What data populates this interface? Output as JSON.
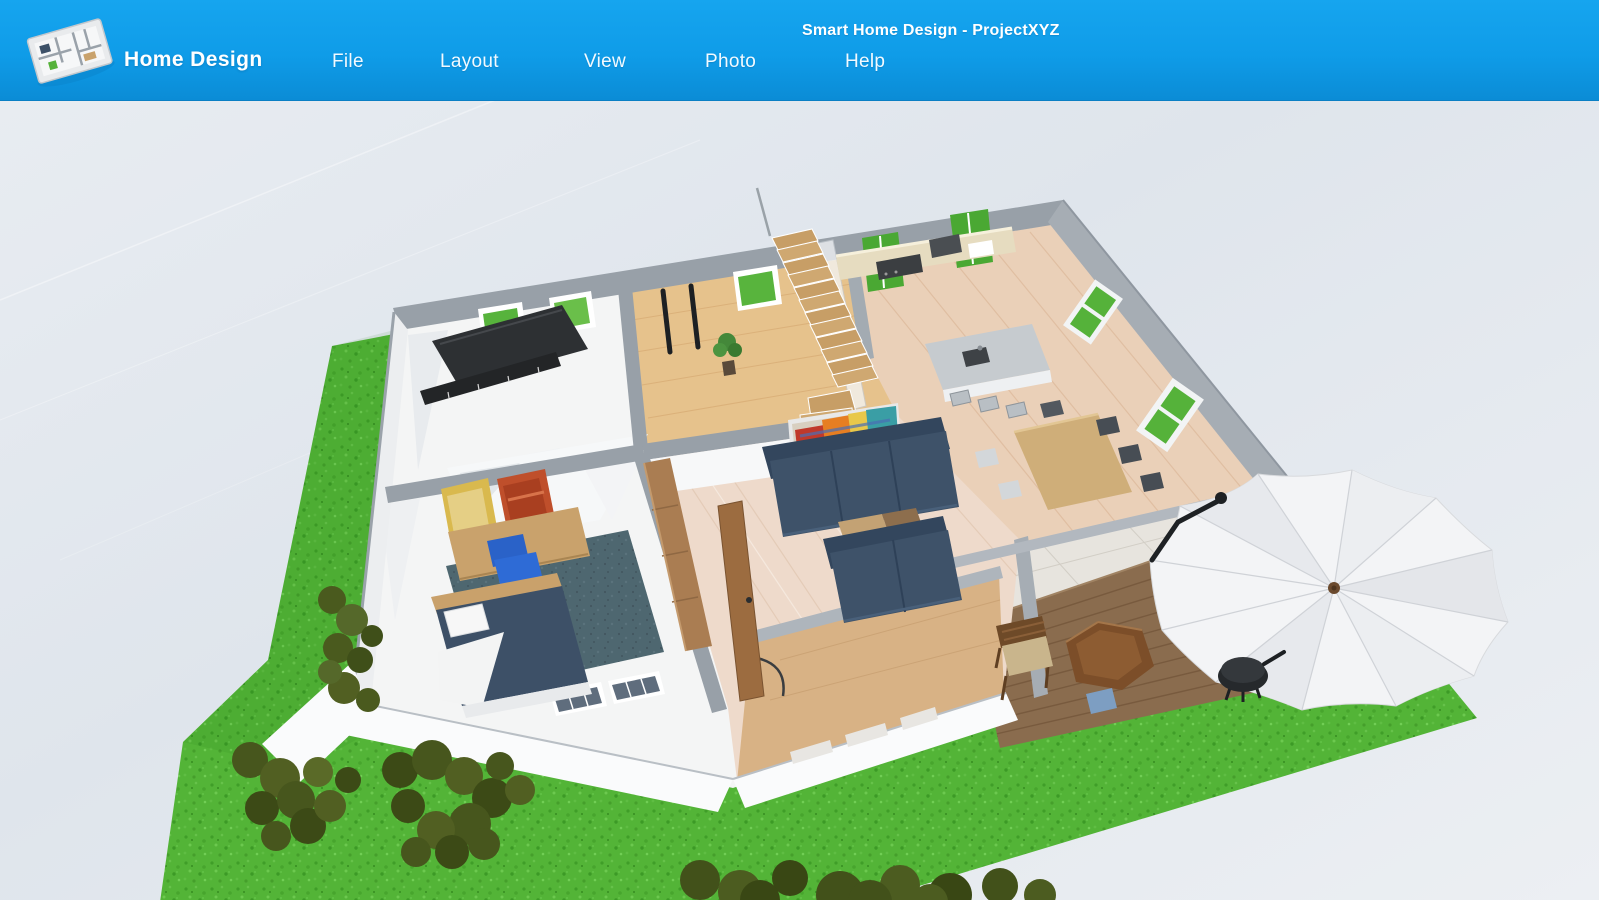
{
  "window": {
    "title": "Smart Home Design - ProjectXYZ"
  },
  "header": {
    "brand": "Home Design",
    "menu_items": [
      {
        "id": "file",
        "label": "File"
      },
      {
        "id": "layout",
        "label": "Layout"
      },
      {
        "id": "view",
        "label": "View"
      },
      {
        "id": "photo",
        "label": "Photo"
      },
      {
        "id": "help",
        "label": "Help"
      }
    ]
  },
  "logo": {
    "name": "floor-plan-logo"
  },
  "theme": {
    "header_blue": "#0f9ce8",
    "header_blue_light": "#16a5ef",
    "header_blue_dark": "#0b8cd6",
    "canvas_bg": "#e0e6ec",
    "grass_green": "#53b437",
    "grass_dark": "#3f9e28",
    "bush_green": "#4a5a1e",
    "wall_gray": "#98a0a8",
    "wood_hall": "#e6c28c",
    "wood_kitchen": "#ead0b8",
    "wood_living": "#eedacb",
    "deck_brown": "#8a6c4e",
    "sofa_navy": "#3e5269",
    "carpet_teal": "#4e6770",
    "office_chair_blue": "#2e6bd6",
    "umbrella_white": "#f3f4f6"
  },
  "scene": {
    "type": "3d-floor-plan-perspective-view",
    "rooms": [
      "piano-room",
      "office-bedroom",
      "entry-hall",
      "kitchen",
      "dining-area",
      "living-room",
      "patio-deck",
      "lawn"
    ],
    "objects": [
      "grand-piano",
      "skis",
      "potted-plant",
      "staircase",
      "kitchen-counter",
      "kitchen-island",
      "bar-stools",
      "dining-table",
      "dining-chairs",
      "wall-painting",
      "sofa-3-seat",
      "loveseat",
      "coffee-table",
      "open-door",
      "desk",
      "posters",
      "office-chair",
      "area-rug",
      "bed",
      "wardrobe",
      "windows",
      "patio-umbrella",
      "hex-table",
      "patio-chair",
      "kettle-grill",
      "garden-tool",
      "bushes"
    ]
  }
}
